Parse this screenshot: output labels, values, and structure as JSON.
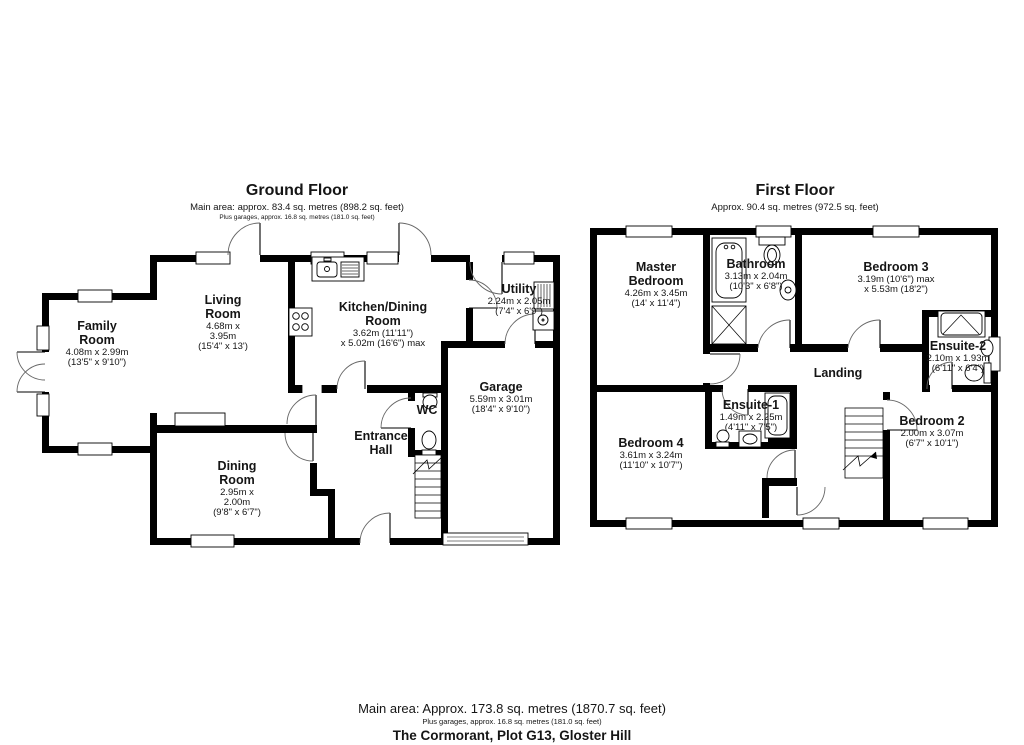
{
  "ground_floor": {
    "title": "Ground Floor",
    "subtitle": "Main area: approx. 83.4 sq. metres (898.2 sq. feet)",
    "subtitle_small": "Plus garages, approx. 16.8 sq. metres (181.0 sq. feet)",
    "rooms": {
      "family": {
        "name": "Family Room",
        "dims": "4.08m x 2.99m",
        "dims_ft": "(13'5\" x 9'10\")"
      },
      "living": {
        "name": "Living Room",
        "dims": "4.68m x 3.95m",
        "dims_ft": "(15'4\" x 13')"
      },
      "kitchen": {
        "name": "Kitchen/Dining Room",
        "dims": "3.62m (11'11\")",
        "dims_ft": "x 5.02m (16'6\") max"
      },
      "utility": {
        "name": "Utility",
        "dims": "2.24m x 2.05m",
        "dims_ft": "(7'4\" x 6'9\")"
      },
      "garage": {
        "name": "Garage",
        "dims": "5.59m x 3.01m",
        "dims_ft": "(18'4\" x 9'10\")"
      },
      "wc": {
        "name": "WC"
      },
      "hall": {
        "name": "Entrance Hall"
      },
      "dining": {
        "name": "Dining Room",
        "dims": "2.95m x 2.00m",
        "dims_ft": "(9'8\" x 6'7\")"
      }
    }
  },
  "first_floor": {
    "title": "First Floor",
    "subtitle": "Approx. 90.4 sq. metres (972.5 sq. feet)",
    "rooms": {
      "master": {
        "name": "Master Bedroom",
        "dims": "4.26m x 3.45m",
        "dims_ft": "(14' x 11'4\")"
      },
      "bathroom": {
        "name": "Bathroom",
        "dims": "3.13m x 2.04m",
        "dims_ft": "(10'3\" x 6'8\")"
      },
      "bedroom3": {
        "name": "Bedroom 3",
        "dims": "3.19m (10'6\") max",
        "dims_ft": "x 5.53m (18'2\")"
      },
      "ensuite2": {
        "name": "Ensuite-2",
        "dims": "2.10m x 1.93m",
        "dims_ft": "(6'11\" x 6'4\")"
      },
      "landing": {
        "name": "Landing"
      },
      "ensuite1": {
        "name": "Ensuite-1",
        "dims": "1.49m x 2.25m",
        "dims_ft": "(4'11\" x 7'5\")"
      },
      "bedroom4": {
        "name": "Bedroom 4",
        "dims": "3.61m x 3.24m",
        "dims_ft": "(11'10\" x 10'7\")"
      },
      "bedroom2": {
        "name": "Bedroom 2",
        "dims": "2.00m x 3.07m",
        "dims_ft": "(6'7\" x 10'1\")"
      }
    }
  },
  "footer": {
    "line1": "Main area: Approx. 173.8 sq. metres (1870.7 sq. feet)",
    "line2": "Plus garages, approx. 16.8 sq. metres (181.0 sq. feet)",
    "line3": "The Cormorant, Plot G13, Gloster Hill"
  },
  "colors": {
    "wall": "#000000",
    "line": "#555555",
    "text": "#151515",
    "background": "#ffffff"
  }
}
